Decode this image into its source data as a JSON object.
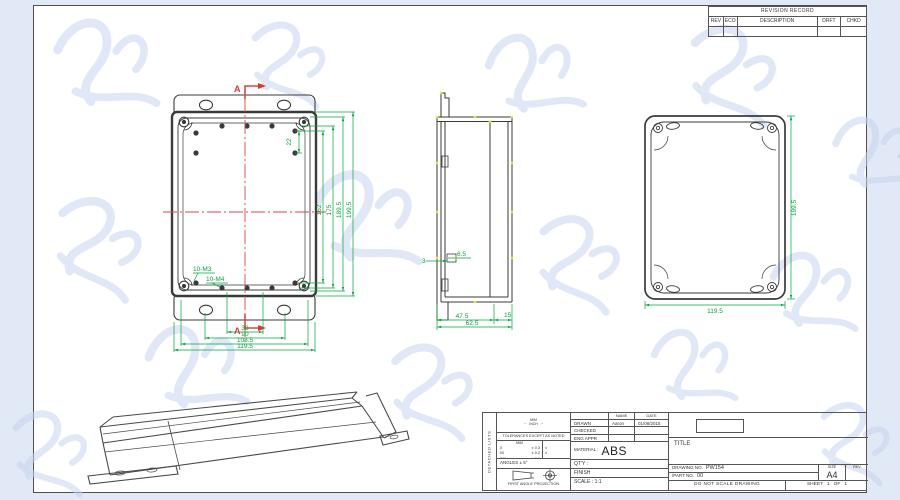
{
  "revision_table": {
    "title": "REVISION RECORD",
    "columns": [
      "REV",
      "ECO",
      "DESCRIPTION",
      "DRFT",
      "CHKD"
    ]
  },
  "views": {
    "front": {
      "section_label": "A",
      "dim_22": "22",
      "thread_label_m3": "10-M3",
      "thread_label_m4": "10-M4",
      "dims_right": [
        "162",
        "175",
        "189.5",
        "199.5"
      ],
      "dims_bottom": [
        "38",
        "90",
        "108.5",
        "119.5"
      ]
    },
    "side": {
      "dim_wall": "3",
      "dim_lip": "6.5",
      "dims_bottom": [
        "47.5",
        "15",
        "62.5"
      ]
    },
    "back": {
      "dim_height": "199.5",
      "dim_width": "119.5"
    }
  },
  "title_block": {
    "strip_label": "DETACHED LISTS",
    "units_top": "MM",
    "units_bottom": "INCH",
    "tolerance_heading": "TOLERANCES EXCEPT AS NOTED",
    "tol_col_header": "MM",
    "tol_rows": [
      {
        "r": ".0",
        "v": "± 0.3",
        "inch": "±"
      },
      {
        "r": ".00",
        "v": "± 0.2",
        "inch": "±"
      },
      {
        "r": ".000",
        "v": "± 0.1",
        "inch": "±"
      }
    ],
    "angles": "ANGLES ± 5°",
    "projection_label": "FIRST ANGLE PROJECTION",
    "name_header": "NAME",
    "date_header": "DATE",
    "rows": [
      {
        "label": "DRAWN",
        "name": "Aaron",
        "date": "01/08/2015"
      },
      {
        "label": "CHECKED",
        "name": "",
        "date": ""
      },
      {
        "label": "ENG APPR",
        "name": "",
        "date": ""
      }
    ],
    "material_label": "MATERIAL :",
    "material": "ABS",
    "qty_label": "QT'Y :",
    "finish_label": "FINISH",
    "scale_label": "SCALE : 1:1",
    "title_label": "TITLE",
    "drawing_no_label": "DRAWING  NO.",
    "drawing_no": "PW154",
    "part_no_label": "/PART  NO.",
    "part_no": "00",
    "size_label": "SIZE",
    "size": "A4",
    "rev_label": "REV",
    "no_scale_note": "DO NOT SCALE DRAWING",
    "sheet_label": "SHEET",
    "sheet_num": "1",
    "of_label": "OF",
    "sheet_total": "1"
  },
  "icons": {
    "arrow_left": "←",
    "arrow_right": "→"
  }
}
